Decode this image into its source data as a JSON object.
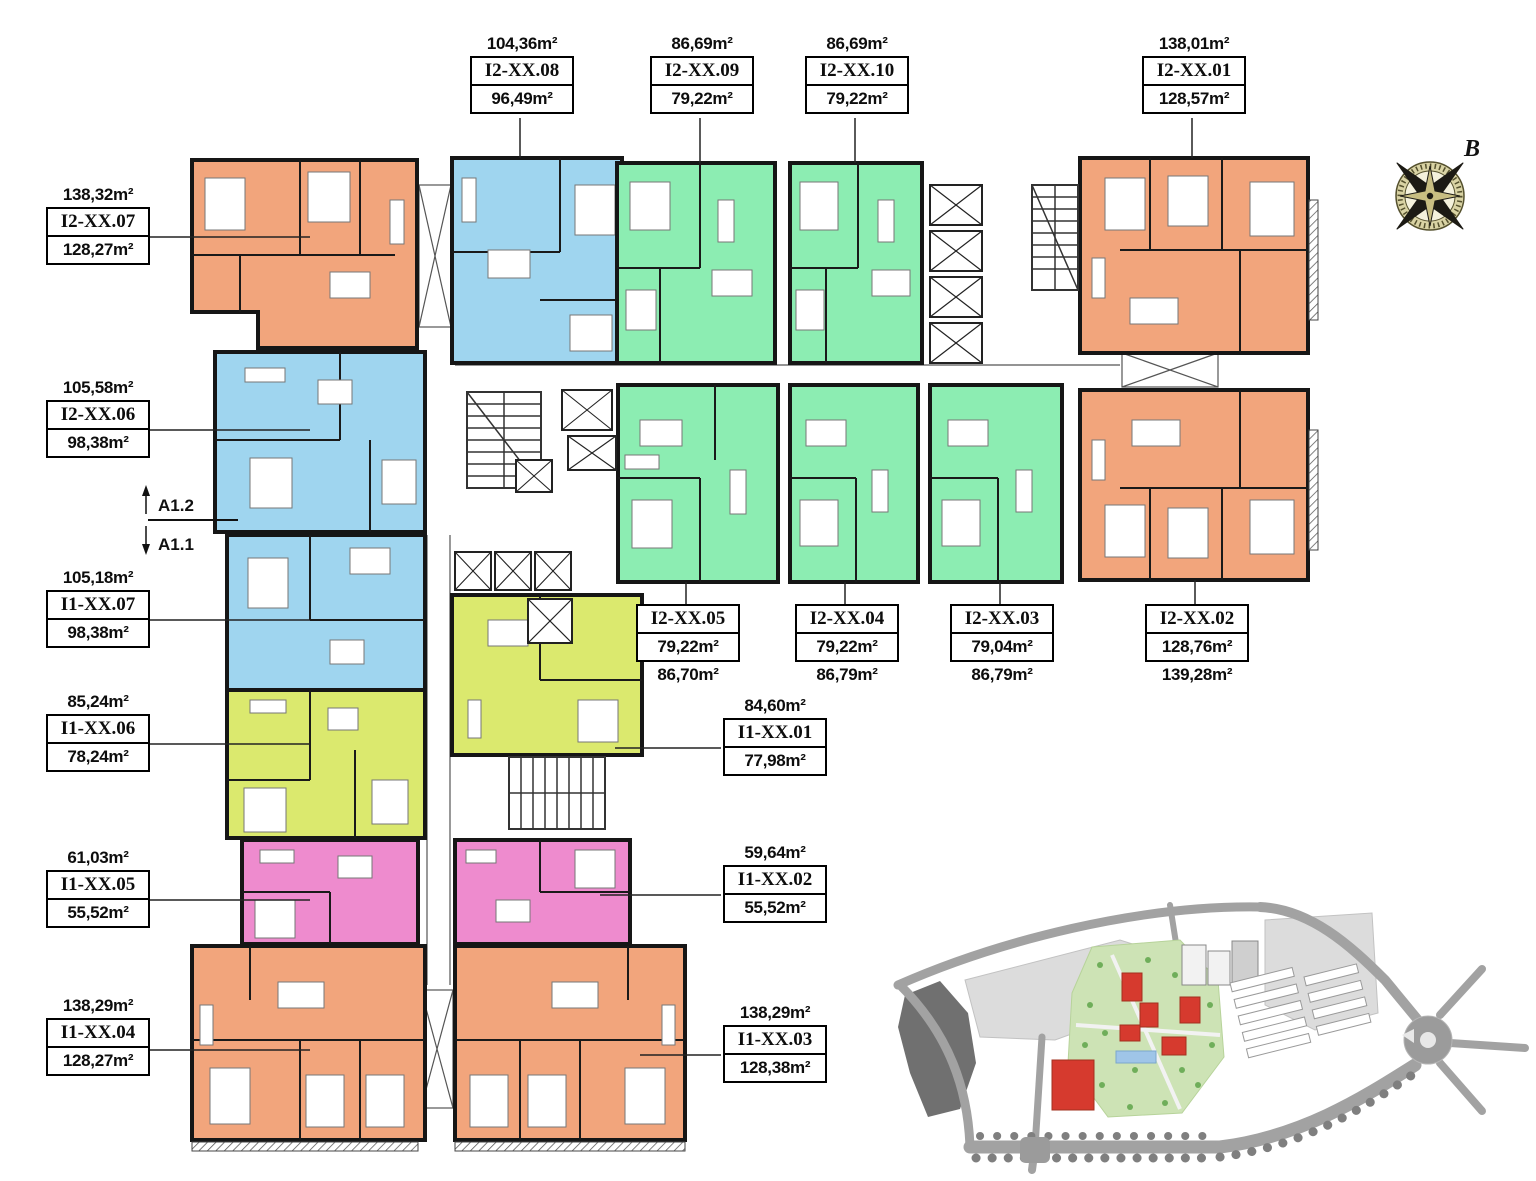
{
  "colors": {
    "orange": "#F2A57C",
    "blue": "#9FD5EF",
    "green": "#8CEDB2",
    "lime": "#DBE96E",
    "pink": "#EE8BCE",
    "wall": "#161616"
  },
  "compass": {
    "north_label": "B"
  },
  "section_marker": {
    "upper": "A1.2",
    "lower": "A1.1"
  },
  "units": [
    {
      "id": "I2-XX.08",
      "area_gross": "104,36m²",
      "area_net": "96,49m²",
      "color": "blue"
    },
    {
      "id": "I2-XX.09",
      "area_gross": "86,69m²",
      "area_net": "79,22m²",
      "color": "green"
    },
    {
      "id": "I2-XX.10",
      "area_gross": "86,69m²",
      "area_net": "79,22m²",
      "color": "green"
    },
    {
      "id": "I2-XX.01",
      "area_gross": "138,01m²",
      "area_net": "128,57m²",
      "color": "orange"
    },
    {
      "id": "I2-XX.07",
      "area_gross": "138,32m²",
      "area_net": "128,27m²",
      "color": "orange"
    },
    {
      "id": "I2-XX.06",
      "area_gross": "105,58m²",
      "area_net": "98,38m²",
      "color": "blue"
    },
    {
      "id": "I1-XX.07",
      "area_gross": "105,18m²",
      "area_net": "98,38m²",
      "color": "blue"
    },
    {
      "id": "I1-XX.06",
      "area_gross": "85,24m²",
      "area_net": "78,24m²",
      "color": "lime"
    },
    {
      "id": "I1-XX.05",
      "area_gross": "61,03m²",
      "area_net": "55,52m²",
      "color": "pink"
    },
    {
      "id": "I1-XX.04",
      "area_gross": "138,29m²",
      "area_net": "128,27m²",
      "color": "orange"
    },
    {
      "id": "I2-XX.05",
      "area_gross": "86,70m²",
      "area_net": "79,22m²",
      "color": "green"
    },
    {
      "id": "I2-XX.04",
      "area_gross": "86,79m²",
      "area_net": "79,22m²",
      "color": "green"
    },
    {
      "id": "I2-XX.03",
      "area_gross": "86,79m²",
      "area_net": "79,04m²",
      "color": "green"
    },
    {
      "id": "I2-XX.02",
      "area_gross": "139,28m²",
      "area_net": "128,76m²",
      "color": "orange"
    },
    {
      "id": "I1-XX.01",
      "area_gross": "84,60m²",
      "area_net": "77,98m²",
      "color": "lime"
    },
    {
      "id": "I1-XX.02",
      "area_gross": "59,64m²",
      "area_net": "55,52m²",
      "color": "pink"
    },
    {
      "id": "I1-XX.03",
      "area_gross": "138,29m²",
      "area_net": "128,38m²",
      "color": "orange"
    }
  ]
}
